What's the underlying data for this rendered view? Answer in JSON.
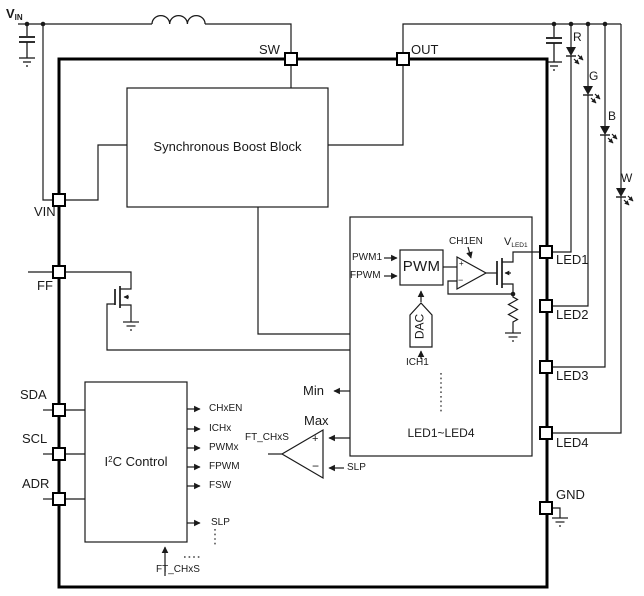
{
  "supply": {
    "vin_base": "V",
    "vin_sub": "IN"
  },
  "pins": {
    "sw": "SW",
    "out": "OUT",
    "vin": "VIN",
    "ff": "FF",
    "sda": "SDA",
    "scl": "SCL",
    "adr": "ADR",
    "led1": "LED1",
    "led2": "LED2",
    "led3": "LED3",
    "led4": "LED4",
    "gnd": "GND"
  },
  "led_strings": {
    "r": "R",
    "g": "G",
    "b": "B",
    "w": "W"
  },
  "blocks": {
    "boost_label": "Synchronous Boost Block",
    "i2c_base": "I",
    "i2c_sup": "2",
    "i2c_rest": "C Control",
    "channel_label": "LED1~LED4",
    "pwm_label": "PWM",
    "dac_label": "DAC"
  },
  "channel_signals": {
    "pwm1": "PWM1",
    "fpwm": "FPWM",
    "ich1": "ICH1",
    "ch1en": "CH1EN",
    "vled1_base": "V",
    "vled1_sub": "LED1",
    "opamp_plus": "+",
    "opamp_minus": "−"
  },
  "i2c_outputs": [
    "CHxEN",
    "ICHx",
    "PWMx",
    "FPWM",
    "FSW",
    "SLP"
  ],
  "i2c_input": {
    "ft_chxs": "FT_CHxS"
  },
  "comparator": {
    "min": "Min",
    "max": "Max",
    "slp": "SLP",
    "ft_chxs": "FT_CHxS",
    "plus": "+",
    "minus": "−"
  },
  "colors": {
    "line": "#1a1a1a",
    "border": "#000000",
    "background": "#ffffff"
  }
}
